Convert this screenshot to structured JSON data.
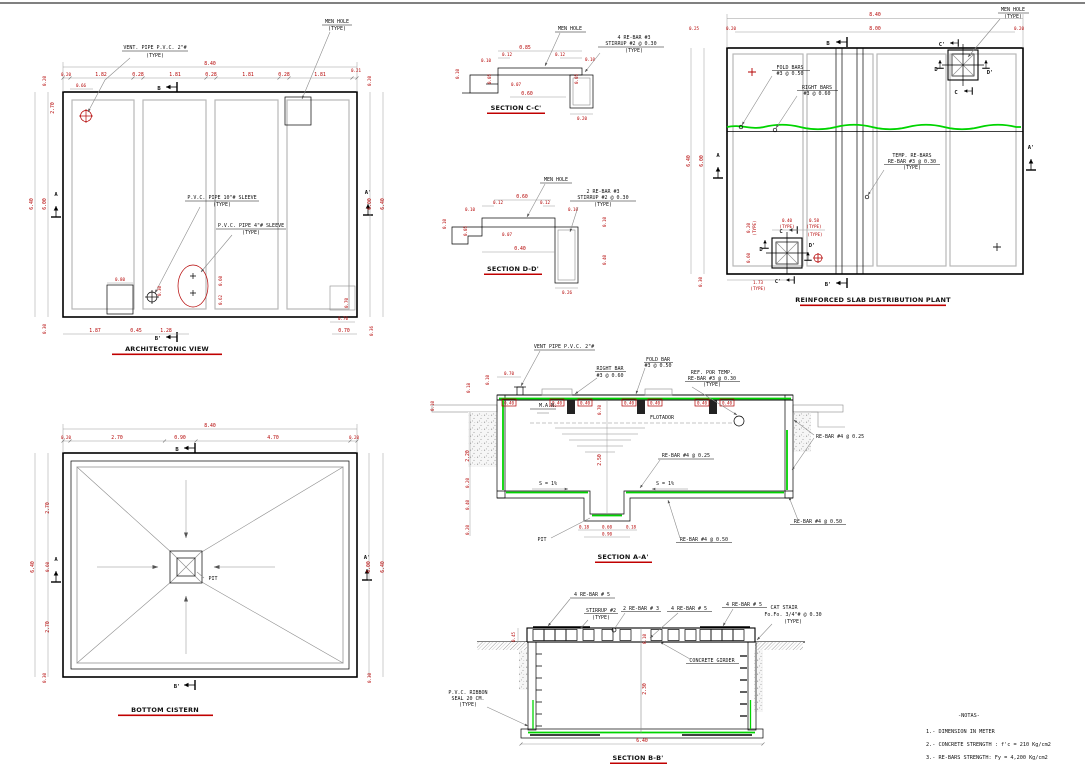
{
  "colors": {
    "dim_red": "#b40000",
    "rebar_green": "#00d400",
    "line_gray": "#8c8c8c",
    "panel_gray": "#b8b8b8"
  },
  "arch": {
    "title": "ARCHITECTONIC VIEW",
    "labels": {
      "vent1": "VENT. PIPE P.V.C. 2\"#",
      "vent2": "(TYPE)",
      "mh1": "MEN HOLE",
      "mh2": "(TYPE)",
      "pvc10a": "P.V.C. PIPE 10\"# SLEEVE",
      "pvc10b": "(TYPE)",
      "pvc4a": "P.V.C. PIPE 4\"# SLEEVE",
      "pvc4b": "(TYPE)"
    },
    "markers": {
      "b": "B",
      "b_p": "B'",
      "a": "A",
      "a_p": "A'"
    },
    "dims": {
      "overall": "8.40",
      "top": [
        "0.20",
        "1.82",
        "0.28",
        "1.81",
        "0.28",
        "1.81",
        "0.28",
        "1.81",
        "0.21"
      ],
      "offset": "0.66",
      "left": {
        "d020": "0.20",
        "d270": "2.70",
        "d640": "6.40",
        "d600": "6.00",
        "d030": "0.30"
      },
      "right": {
        "d020": "0.20",
        "d600": "6.00",
        "d640": "6.40",
        "d036": "0.36"
      },
      "bottom": [
        "1.87",
        "0.45",
        "1.28",
        "0.70"
      ],
      "inner": {
        "d080": "0.80",
        "d030": "0.30",
        "d060": "0.60",
        "d062": "0.62",
        "d070a": "0.70",
        "d070b": "0.70"
      }
    }
  },
  "cistern": {
    "title": "BOTTOM CISTERN",
    "pit_label": "PIT",
    "markers": {
      "b": "B",
      "b_p": "B'",
      "a": "A",
      "a_p": "A'"
    },
    "dims": {
      "overall": "8.40",
      "top": [
        "0.20",
        "2.70",
        "0.90",
        "4.70",
        "0.20"
      ],
      "left": [
        "2.70",
        "0.60",
        "2.70"
      ],
      "left_640": "6.40",
      "left_030": "0.30",
      "right_600": "6.00",
      "right_640": "6.40",
      "right_030": "0.30"
    }
  },
  "secC": {
    "title": "SECTION C-C'",
    "labels": {
      "mh": "MEN HOLE",
      "l1": "4 RE-BAR #3",
      "l2": "STIRRUP #2 @ 0.30",
      "l3": "(TYPE)"
    },
    "dims": {
      "d085": "0.85",
      "d012a": "0.12",
      "d012b": "0.12",
      "d010a": "0.10",
      "d010b": "0.10",
      "d010c": "0.10",
      "d005a": "0.05",
      "d005b": "0.05",
      "d007": "0.07",
      "d060": "0.60",
      "d020": "0.20"
    }
  },
  "secD": {
    "title": "SECTION D-D'",
    "labels": {
      "mh": "MEN HOLE",
      "l1": "2 RE-BAR #3",
      "l2": "STIRRUP #2 @ 0.30",
      "l3": "(TYPE)"
    },
    "dims": {
      "d060": "0.60",
      "d012a": "0.12",
      "d012b": "0.12",
      "d010a": "0.10",
      "d010b": "0.10",
      "d010c": "0.10",
      "d010d": "0.10",
      "d005": "0.05",
      "d007": "0.07",
      "d040a": "0.40",
      "d040b": "0.40",
      "d026": "0.26"
    }
  },
  "slab": {
    "title": "REINFORCED SLAB DISTRIBUTION PLANT",
    "labels": {
      "mh1": "MEN HOLE",
      "mh2": "(TYPE)",
      "fold1": "FOLD BARS",
      "fold2": "#3 @ 0.50",
      "right1": "RIGHT BARS",
      "right2": "#3 @ 0.60",
      "temp1": "TEMP. RE-BARS",
      "temp2": "RE-BAR #3 @ 0.30",
      "temp3": "(TYPE)"
    },
    "markers": {
      "b": "B",
      "b_p": "B'",
      "a": "A",
      "a_p": "A'",
      "c_tr": "C",
      "cp_tr": "C'",
      "d_tr": "D",
      "dp_tr": "D'",
      "c_bl": "C",
      "cp_bl": "C'",
      "d_bl": "D",
      "dp_bl": "D'"
    },
    "dims": {
      "d840": "8.40",
      "d800": "8.00",
      "t020a": "0.20",
      "t020b": "0.20",
      "l025": "0.25",
      "l640": "6.40",
      "l600": "6.00",
      "l030": "0.30",
      "mh020": "0.20",
      "mh040": "0.40",
      "mh058": "0.58",
      "mh060": "0.60",
      "d173": "1.73",
      "type1": "(TYPE)",
      "type2": "(TYPE)",
      "type3": "(TYPE)",
      "type4": "(TYPE)",
      "type5": "(TYPE)"
    }
  },
  "secA": {
    "title": "SECTION A-A'",
    "labels": {
      "vent": "VENT PIPE P.V.C. 2\"#",
      "right1": "RIGHT BAR",
      "right2": "#3 @ 0.60",
      "fold1": "FOLD BAR",
      "fold2": "#3 @ 0.50",
      "ref1": "REF. POR TEMP.",
      "ref2": "RE-BAR #3 @ 0.30",
      "ref3": "(TYPE)",
      "man": "M.A.N.",
      "flot": "FLOTADOR",
      "rebar25": "RE-BAR #4 @ 0.25",
      "s_left": "S = 1%",
      "s_right": "S = 1%",
      "pit": "PIT",
      "rebar_edge": "RE-BAR #4 @ 0.25",
      "rebar50a": "RE-BAR #4 @ 0.50",
      "rebar50b": "RE-BAR #4 @ 0.50"
    },
    "dims": {
      "d010a": "0.10",
      "d018": "0.18",
      "d010b": "0.10",
      "d070t": "0.70",
      "boxes": [
        "0.40",
        "0.40",
        "0.40",
        "0.40",
        "0.40",
        "0.40",
        "0.40"
      ],
      "d070m": "0.70",
      "d250": "2.50",
      "d220": "2.20",
      "d020a": "0.20",
      "d040": "0.40",
      "d020b": "0.20",
      "p018a": "0.18",
      "p060": "0.60",
      "p090": "0.90",
      "p018b": "0.18"
    }
  },
  "secB": {
    "title": "SECTION B-B'",
    "labels": {
      "r5a": "4 RE-BAR # 5",
      "stir1": "STIRRUP #2",
      "stir2": "(TYPE)",
      "r3": "2 RE-BAR # 3",
      "r5b": "4 RE-BAR # 5",
      "r5c": "4 RE-BAR # 5",
      "cat1": "CAT STAIR",
      "cat2": "Fo.Fo. 3/4\"# @ 0.30",
      "cat3": "(TYPE)",
      "girder": "CONCRETE GIRDER",
      "rib1": "P.V.C. RIBBON",
      "rib2": "SEAL 20 CM.",
      "rib3": "(TYPE)"
    },
    "dims": {
      "d045": "0.45",
      "d010": "0.10",
      "d230": "2.30",
      "d640": "6.40"
    }
  },
  "notes": {
    "title": "-NOTAS-",
    "items": [
      "1.- DIMENSION IN METER",
      "2.- CONCRETE STRENGTH : f'c = 210 Kg/cm2",
      "3.- RE-BARS STRENGTH: Fy = 4,200 Kg/cm2"
    ]
  }
}
